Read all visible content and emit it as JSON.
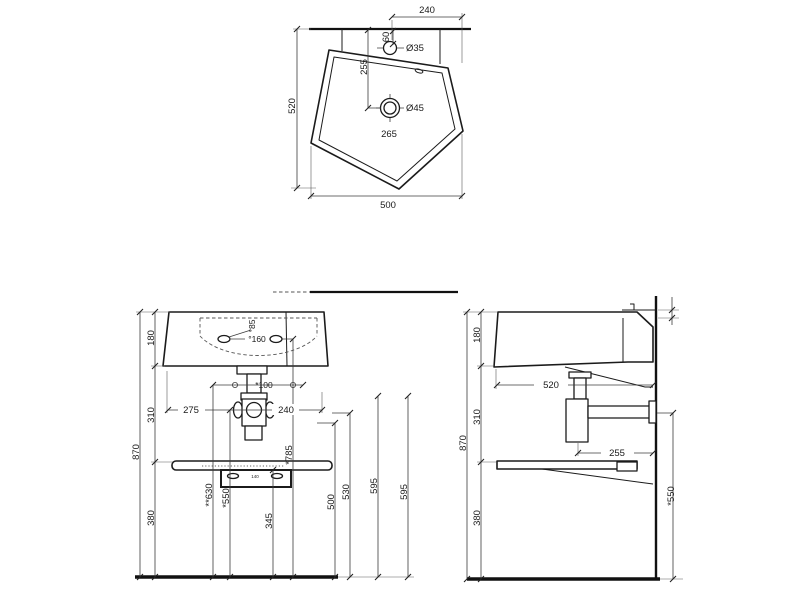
{
  "drawing_type": "technical-dimension-drawing",
  "subject": "wall-hung-basin-three-views",
  "palette": {
    "line": "#1b1b1b",
    "background": "#ffffff"
  },
  "views": {
    "top": {
      "dims": {
        "d240": "240",
        "d60": "60",
        "tap_hole": "Ø35",
        "d255": "255",
        "drain_hole": "Ø45",
        "d265": "265",
        "d520": "520",
        "d500": "500"
      }
    },
    "front": {
      "dims": {
        "h180": "180",
        "h310": "310",
        "h870": "870",
        "h380": "380",
        "d85": "°85",
        "d160": "°160",
        "d100": "*100",
        "d275": "275",
        "d240": "240",
        "h630": "**630",
        "h550": "*550",
        "h345": "345",
        "h785": "*785",
        "h500": "500",
        "h530": "530",
        "h595a": "595",
        "h595b": "595",
        "d140": "140"
      }
    },
    "side": {
      "dims": {
        "h180": "180",
        "h310": "310",
        "h870": "870",
        "h380": "380",
        "d520": "520",
        "d255": "255",
        "h550": "*550"
      }
    }
  }
}
